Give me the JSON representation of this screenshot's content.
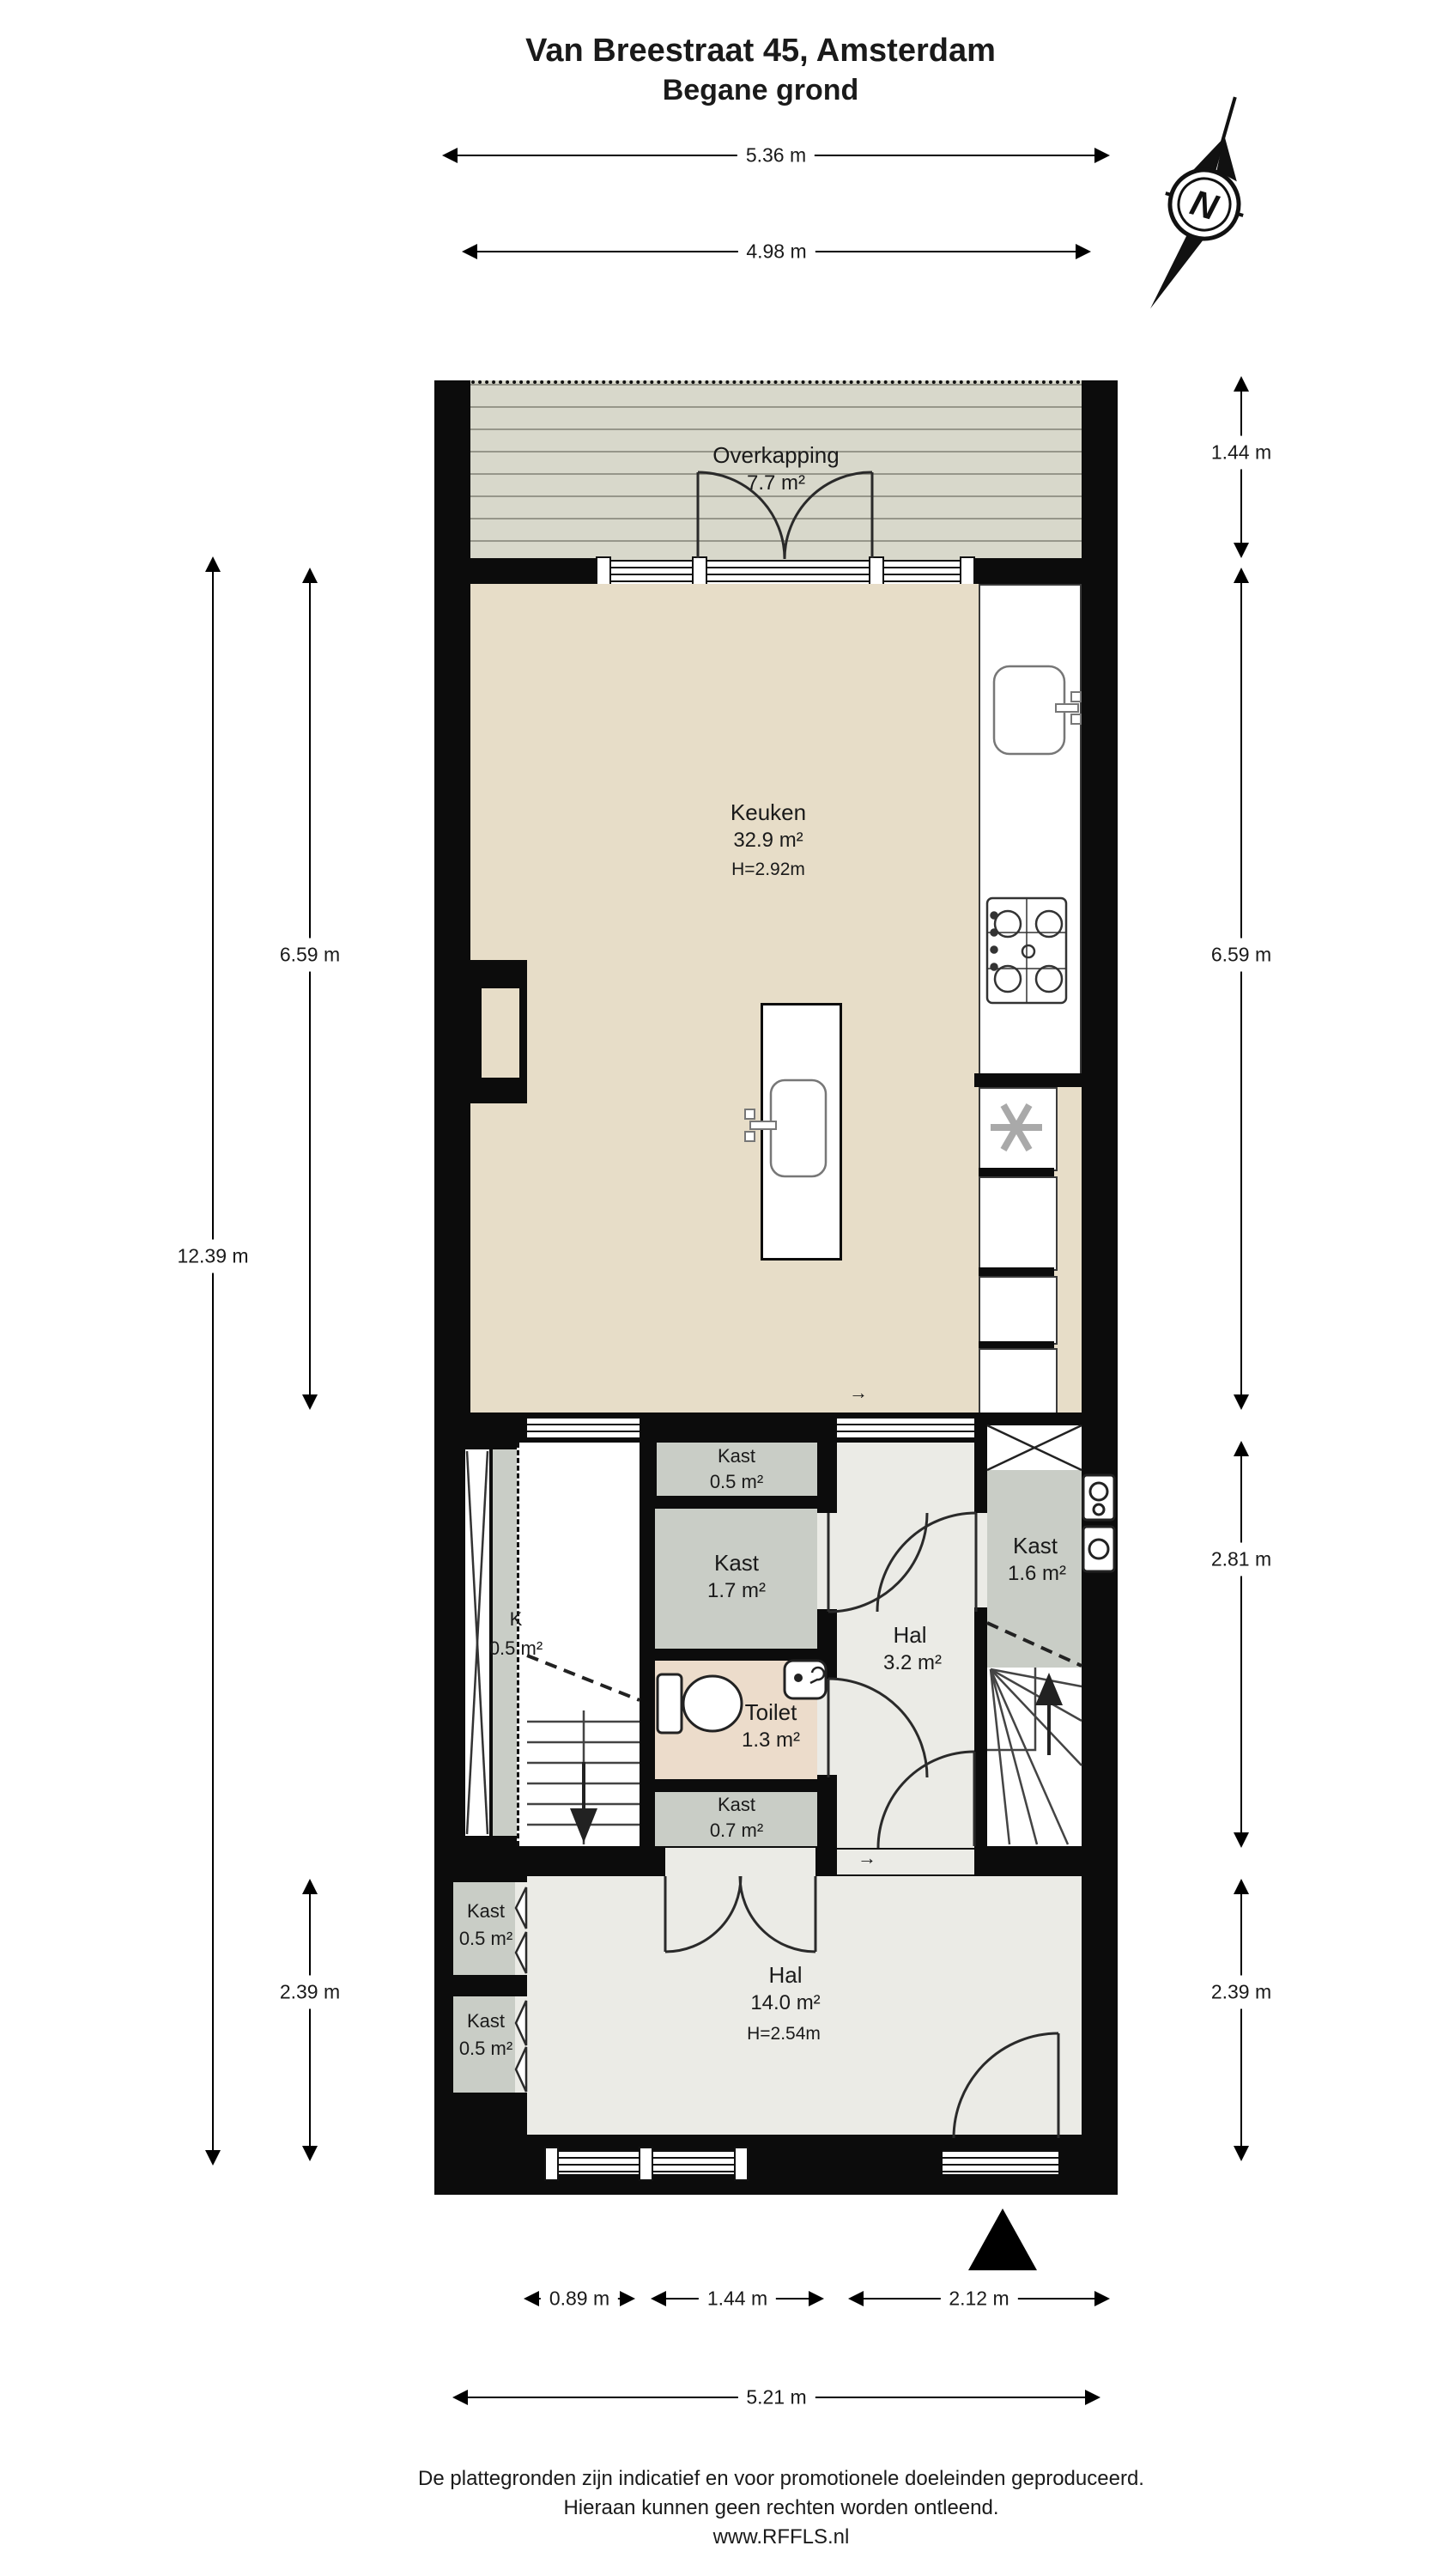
{
  "header": {
    "title": "Van Breestraat 45, Amsterdam",
    "subtitle": "Begane grond"
  },
  "compass": {
    "north_label": "N"
  },
  "rooms": {
    "overkapping": {
      "name": "Overkapping",
      "area": "7.7 m²"
    },
    "keuken": {
      "name": "Keuken",
      "area": "32.9 m²",
      "ceiling": "H=2.92m"
    },
    "kast_top": {
      "name": "Kast",
      "area": "0.5 m²"
    },
    "kast_mid": {
      "name": "Kast",
      "area": "1.7 m²"
    },
    "toilet": {
      "name": "Toilet",
      "area": "1.3 m²"
    },
    "kast_bottom": {
      "name": "Kast",
      "area": "0.7 m²"
    },
    "hal_mid": {
      "name": "Hal",
      "area": "3.2 m²"
    },
    "kast_right": {
      "name": "Kast",
      "area": "1.6 m²"
    },
    "kast_left_strip": {
      "name": "K",
      "area": "0.5 m²"
    },
    "hal_entree": {
      "name": "Hal",
      "area": "14.0 m²",
      "ceiling": "H=2.54m"
    },
    "kast_hal_a": {
      "name": "Kast",
      "area": "0.5 m²"
    },
    "kast_hal_b": {
      "name": "Kast",
      "area": "0.5 m²"
    }
  },
  "dimensions": {
    "top_outer": "5.36 m",
    "top_inner": "4.98 m",
    "left_total": "12.39 m",
    "left_keuken": "6.59 m",
    "left_hal": "2.39 m",
    "right_overkapping": "1.44 m",
    "right_keuken": "6.59 m",
    "right_mid": "2.81 m",
    "right_hal": "2.39 m",
    "bottom_kast": "0.89 m",
    "bottom_mid": "1.44 m",
    "bottom_entry": "2.12 m",
    "bottom_total": "5.21 m"
  },
  "symbols": {
    "direction_arrow": "→"
  },
  "footer": {
    "line1": "De plattegronden zijn indicatief en voor promotionele doeleinden geproduceerd.",
    "line2": "Hieraan kunnen geen rechten worden ontleend.",
    "line3": "www.RFFLS.nl"
  }
}
